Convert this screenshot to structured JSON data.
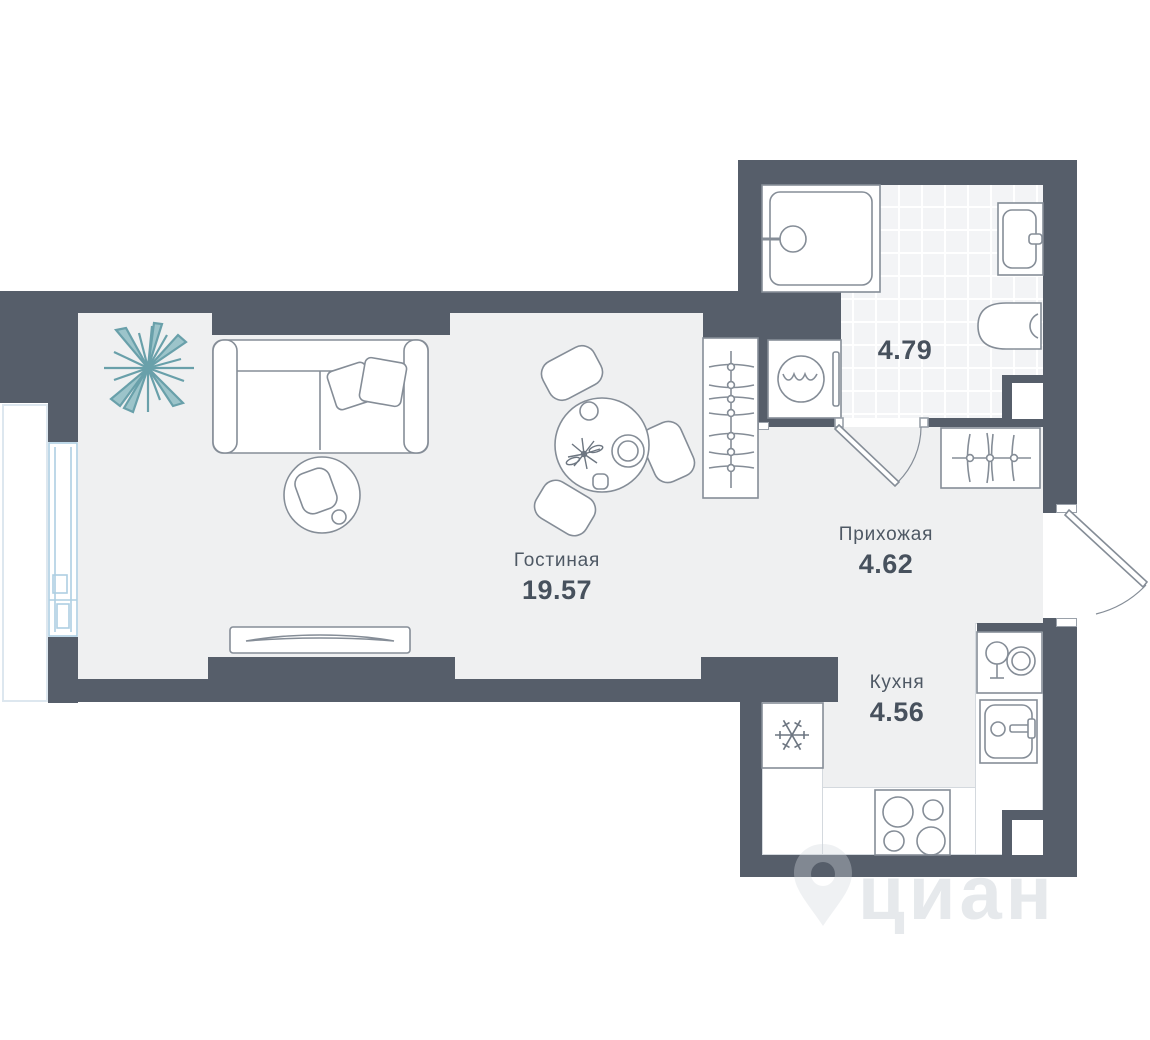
{
  "floorplan": {
    "watermark": "циан",
    "rooms": [
      {
        "id": "living",
        "label": "Гостиная",
        "area": "19.57"
      },
      {
        "id": "hallway",
        "label": "Прихожая",
        "area": "4.62"
      },
      {
        "id": "kitchen",
        "label": "Кухня",
        "area": "4.56"
      },
      {
        "id": "bathroom",
        "label": "",
        "area": "4.79"
      }
    ],
    "colors": {
      "wall": "#565e6a",
      "floor": "#eff0f1",
      "tile": "#f3f4f6",
      "outline": "#858d97",
      "window": "#aecfe2",
      "plant": "#9cc4ca",
      "label": "#4e5864"
    },
    "furniture": [
      "sofa",
      "pillows",
      "armchair",
      "tv-stand",
      "plant",
      "dining-table",
      "dining-chairs",
      "wardrobe-hangers",
      "coat-rack",
      "washing-machine",
      "shower",
      "bathroom-sink",
      "toilet",
      "fridge",
      "stove",
      "kitchen-sink",
      "dish-rack",
      "window",
      "balcony",
      "entrance-door",
      "bathroom-door"
    ]
  }
}
